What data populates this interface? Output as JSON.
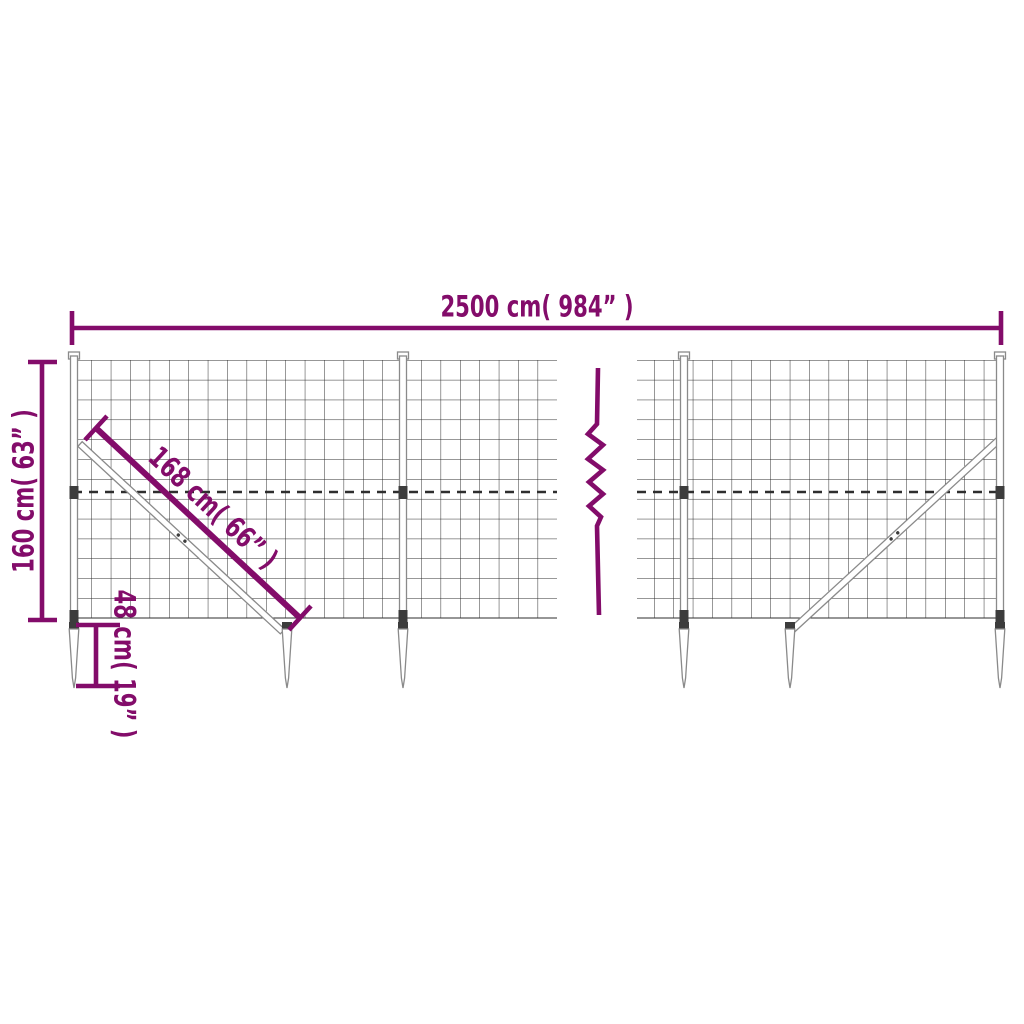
{
  "diagram": {
    "labels": {
      "total_width": "2500 cm( 984” )",
      "height": "160 cm( 63” )",
      "brace_length": "168 cm( 66” )",
      "spike_depth": "48 cm( 19” )"
    },
    "colors": {
      "dimension_purple": "#830c6a",
      "mesh_line": "#2e2e2e",
      "hardware_outline": "#8a8a8a",
      "clamp_dark": "#3c3c3c",
      "background": "#ffffff"
    }
  }
}
